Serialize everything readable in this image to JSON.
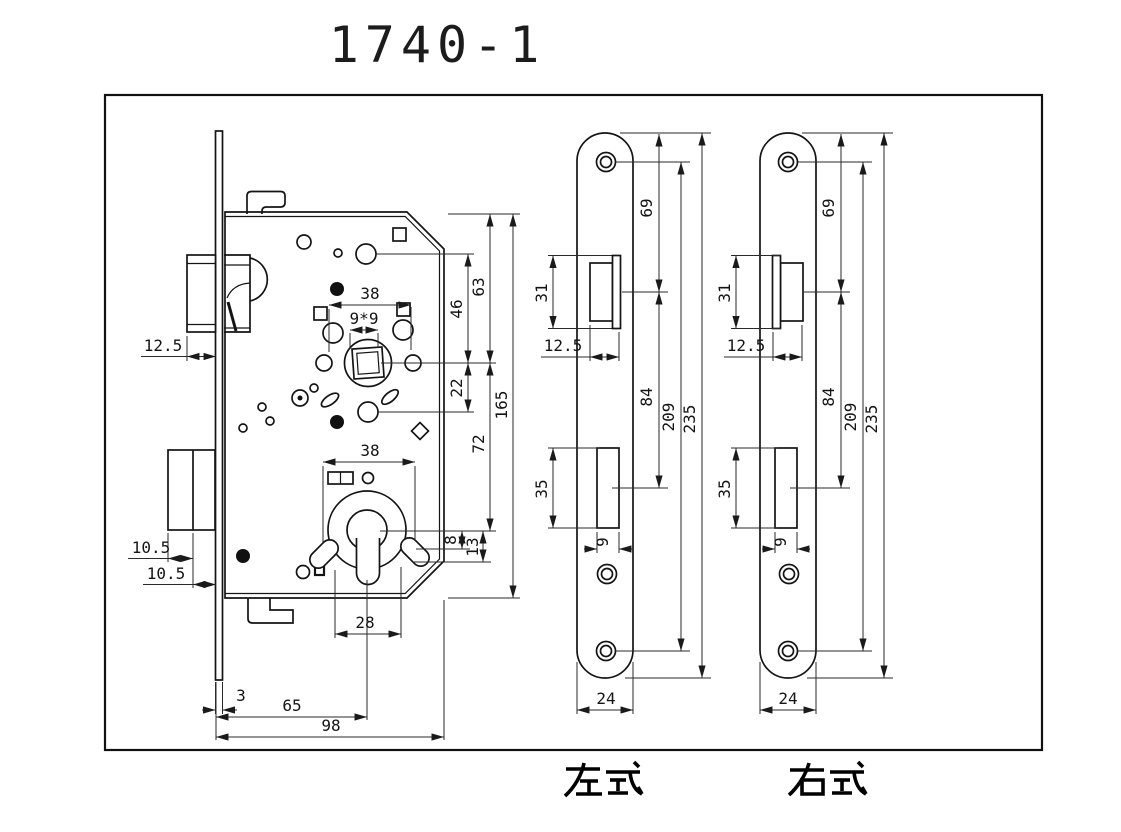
{
  "title": "1740-1",
  "colors": {
    "line": "#141414",
    "background": "#ffffff"
  },
  "views": {
    "body": {
      "name": "lock body section view",
      "dims": {
        "latch_protrusion": "12.5",
        "top_span": "38",
        "spindle": "9*9",
        "hole_to_spindle": "46",
        "top_to_spindle": "63",
        "spindle_to_hole": "22",
        "total_height": "165",
        "spindle_to_cylinder": "72",
        "cylinder_span": "38",
        "bolt_throw_a": "10.5",
        "bolt_throw_b": "10.5",
        "cyl_offset_a": "8",
        "cyl_offset_b": "13",
        "ear_span": "28",
        "faceplate_thickness": "3",
        "backset": "65",
        "body_depth": "98"
      }
    },
    "left_plate": {
      "label": "左式",
      "dims": {
        "latch_cut_height": "31",
        "top_to_latch": "69",
        "latch_cut_depth": "12.5",
        "latch_to_bolt": "84",
        "screw_span": "209",
        "plate_length": "235",
        "bolt_cut_height": "35",
        "bolt_cut_width": "9",
        "plate_width": "24"
      }
    },
    "right_plate": {
      "label": "右式",
      "dims": {
        "latch_cut_height": "31",
        "top_to_latch": "69",
        "latch_cut_depth": "12.5",
        "latch_to_bolt": "84",
        "screw_span": "209",
        "plate_length": "235",
        "bolt_cut_height": "35",
        "bolt_cut_width": "9",
        "plate_width": "24"
      }
    }
  }
}
